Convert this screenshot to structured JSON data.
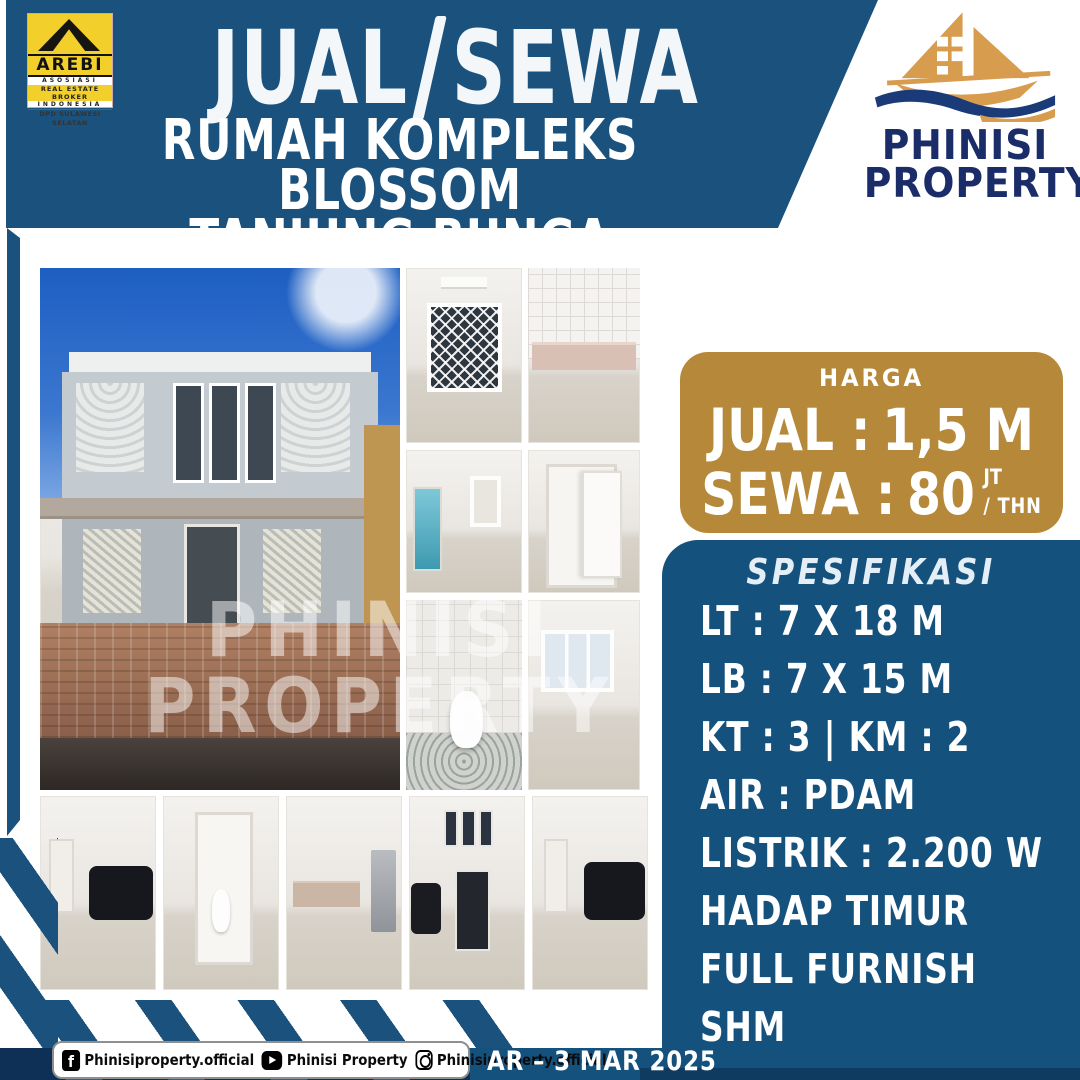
{
  "header": {
    "title_left": "JUAL",
    "title_right": "SEWA",
    "subtitle_line1": "RUMAH KOMPLEKS BLOSSOM",
    "subtitle_line2": "TANJUNG BUNGA"
  },
  "arebi": {
    "name": "AREBI",
    "line1": "ASOSIASI",
    "line2": "REAL ESTATE BROKER",
    "line3": "INDONESIA",
    "line4": "DPD SULAWESI SELATAN"
  },
  "brand": {
    "name_line1": "PHINISI",
    "name_line2": "PROPERTY"
  },
  "price": {
    "box_label": "HARGA",
    "sell_label": "JUAL :",
    "sell_value": "1,5 M",
    "rent_label": "SEWA :",
    "rent_value": "80",
    "rent_unit": "JT",
    "rent_per": "/ THN"
  },
  "specs": {
    "title": "SPESIFIKASI",
    "items": [
      "LT : 7 X 18 M",
      "LB : 7 X 15 M",
      "KT : 3 | KM : 2",
      "AIR : PDAM",
      "LISTRIK : 2.200 W",
      "HADAP TIMUR",
      "FULL FURNISH",
      "SHM"
    ]
  },
  "watermark": {
    "line1": "PHINISI",
    "line2": "PROPERTY"
  },
  "footer": {
    "socials": [
      {
        "network": "facebook",
        "handle": "Phinisiproperty.official"
      },
      {
        "network": "youtube",
        "handle": "Phinisi Property"
      },
      {
        "network": "instagram",
        "handle": "Phinisiproperty.official"
      }
    ],
    "agent_date": "AR – 3 MAR 2025"
  },
  "colors": {
    "header_blue": "#1A527D",
    "panel_blue": "#15517D",
    "price_gold": "#B6893A",
    "footer_navy": "#0F3056",
    "brand_navy": "#1B2D69",
    "ship_gold": "#D79C4D",
    "arebi_yellow": "#F2CF2A"
  }
}
